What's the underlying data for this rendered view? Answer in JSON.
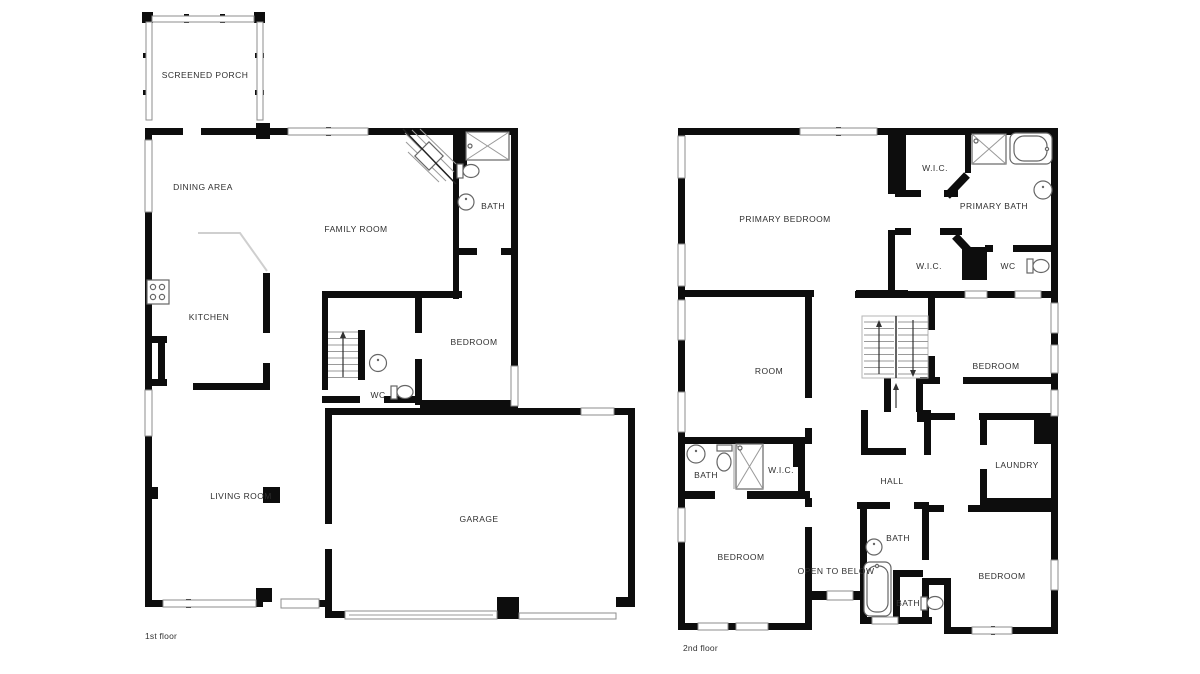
{
  "document": {
    "type": "floor-plan",
    "background": "#ffffff",
    "wall_color": "#0d0d0d",
    "label_color": "#2f2f2f"
  },
  "floors": [
    {
      "caption": "1st floor",
      "rooms": [
        {
          "label": "SCREENED PORCH"
        },
        {
          "label": "DINING AREA"
        },
        {
          "label": "FAMILY ROOM"
        },
        {
          "label": "BATH"
        },
        {
          "label": "KITCHEN"
        },
        {
          "label": "BEDROOM"
        },
        {
          "label": "WC"
        },
        {
          "label": "LIVING ROOM"
        },
        {
          "label": "GARAGE"
        }
      ]
    },
    {
      "caption": "2nd floor",
      "rooms": [
        {
          "label": "W.I.C."
        },
        {
          "label": "PRIMARY BATH"
        },
        {
          "label": "PRIMARY BEDROOM"
        },
        {
          "label": "W.I.C."
        },
        {
          "label": "WC"
        },
        {
          "label": "ROOM"
        },
        {
          "label": "BEDROOM"
        },
        {
          "label": "BATH"
        },
        {
          "label": "W.I.C."
        },
        {
          "label": "LAUNDRY"
        },
        {
          "label": "HALL"
        },
        {
          "label": "BEDROOM"
        },
        {
          "label": "OPEN TO BELOW"
        },
        {
          "label": "BATH"
        },
        {
          "label": "BATH"
        },
        {
          "label": "BEDROOM"
        }
      ]
    }
  ]
}
